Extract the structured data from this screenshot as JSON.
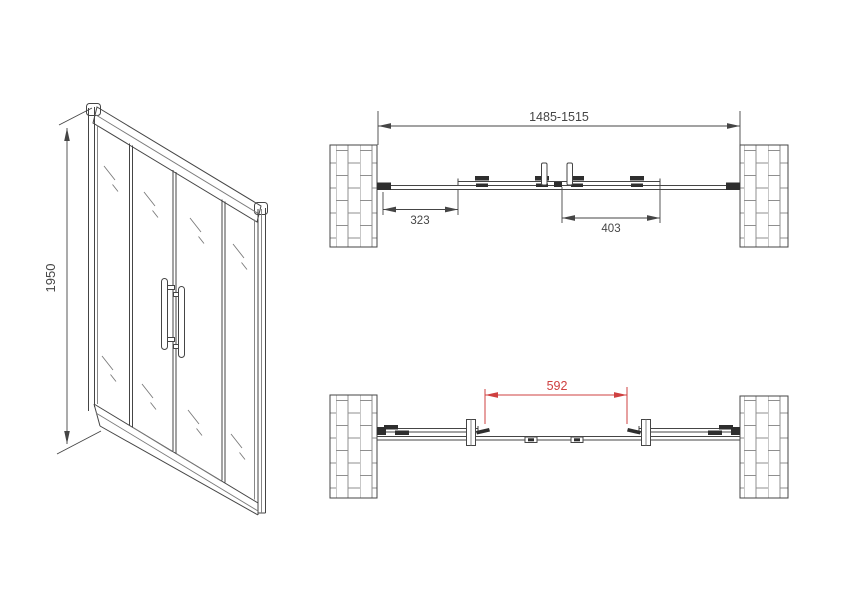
{
  "drawing_type": "shower-sliding-door-technical-drawing",
  "colors": {
    "line": "#454545",
    "dark": "#2e2e2e",
    "brick": "#8f8f8f",
    "red": "#cf4040",
    "bg": "#ffffff"
  },
  "front_view": {
    "height_dim": "1950"
  },
  "top_view": {
    "overall_dim": "1485-1515",
    "left_dim": "323",
    "right_dim": "403"
  },
  "open_view": {
    "opening_dim": "592"
  }
}
